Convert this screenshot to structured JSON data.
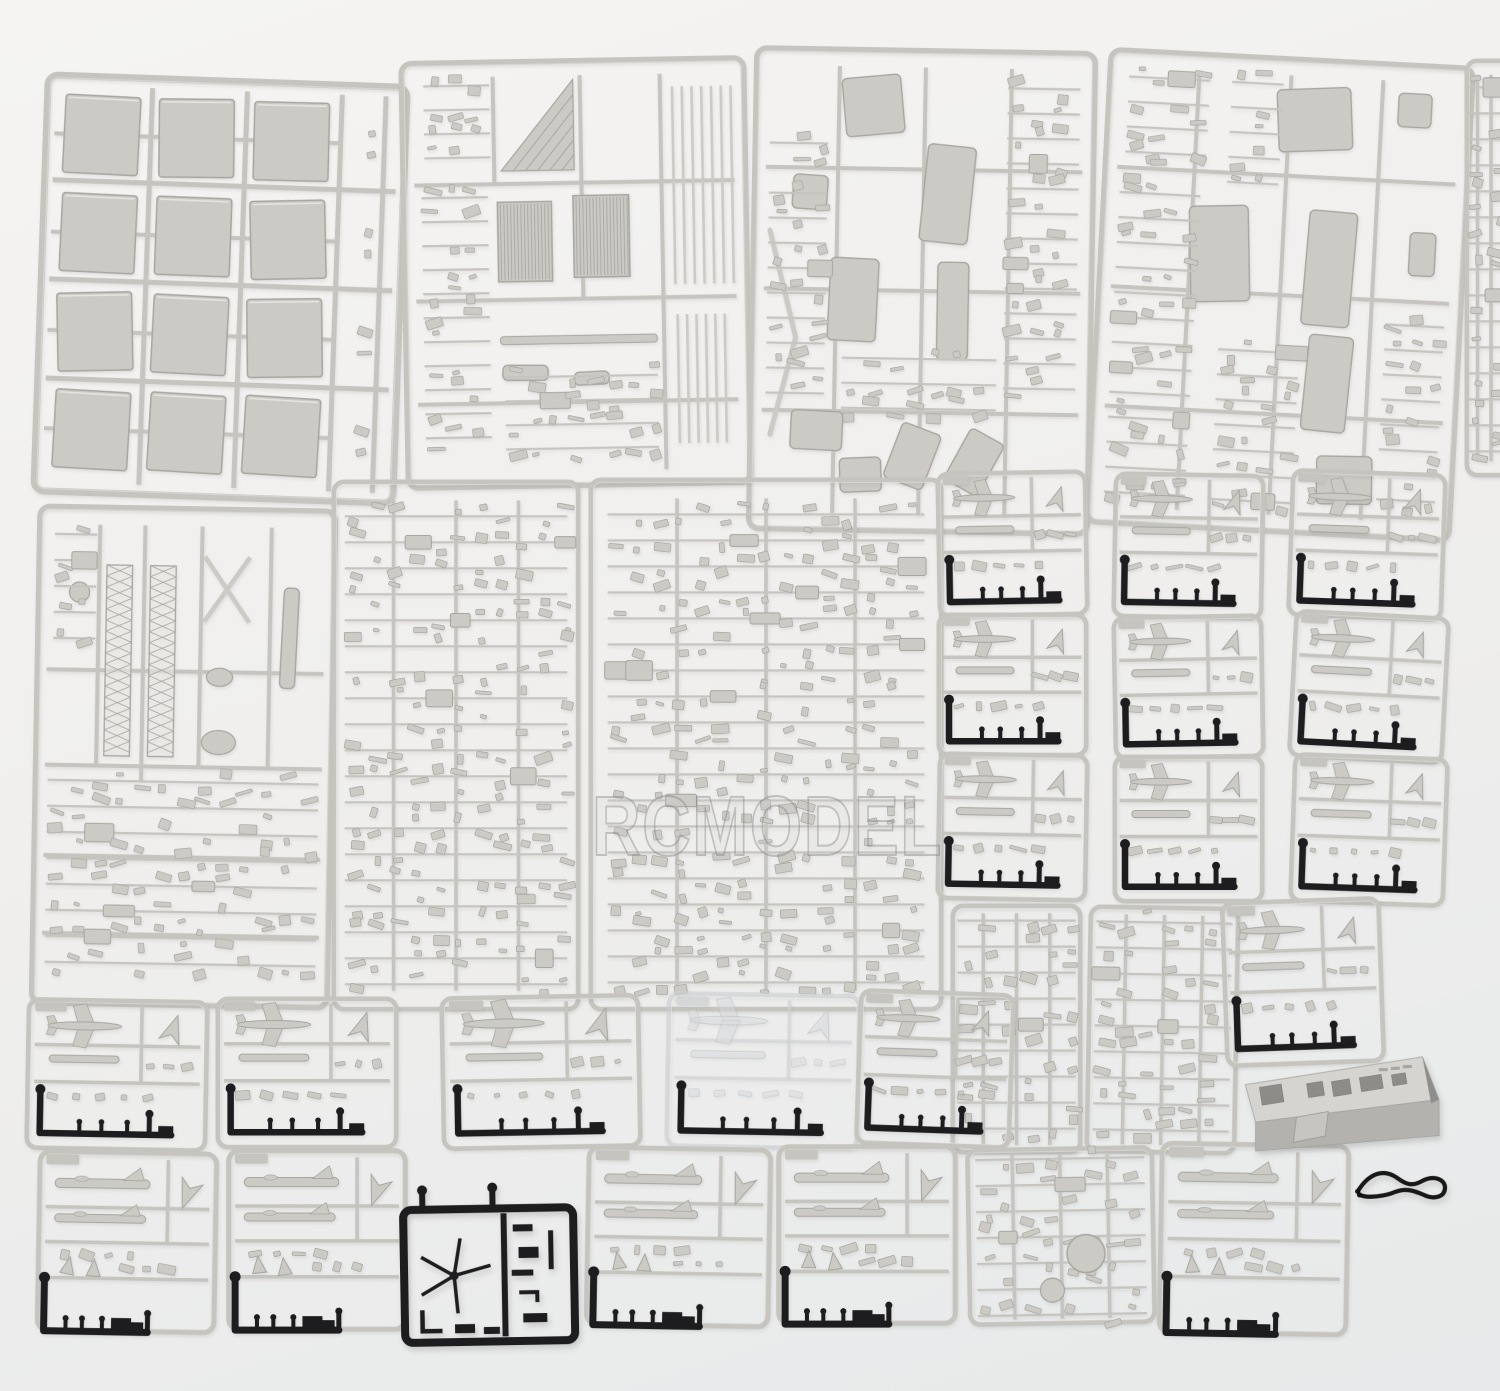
{
  "meta": {
    "width": 1500,
    "height": 1391,
    "description": "Overhead photo of an unassembled plastic scale-model kit: about 30 light-gray injection-molded sprues of ship and aircraft parts, several black sprues, a gray hull box part and a small black cord on a white backdrop"
  },
  "watermark": {
    "text": "RCMODEL"
  },
  "palette": {
    "background_top": "#f5f4f2",
    "background_mid": "#f0efed",
    "background_bottom": "#e7e9ea",
    "gray_frame": "#c5c4bf",
    "gray_part": "#cbcac5",
    "gray_edge": "#a7a6a1",
    "black_plastic": "#1d1d1f",
    "clear_frame": "rgba(207,209,212,0.65)",
    "clear_part": "rgba(220,222,225,0.50)",
    "clear_edge": "rgba(186,188,191,0.55)",
    "box_top": "#d5d4d0",
    "box_front": "#b3b2ae",
    "box_side": "#8f8e8a",
    "watermark_fill": "rgba(205,205,203,0.14)",
    "watermark_stroke": "rgba(125,125,123,0.40)"
  },
  "sprues": [
    {
      "name": "sprue-deck-panels",
      "kind": "deck",
      "x": 38,
      "y": 78,
      "w": 365,
      "h": 422,
      "rot": 2,
      "seed": 11
    },
    {
      "name": "sprue-grating-rods",
      "kind": "grating",
      "x": 402,
      "y": 58,
      "w": 348,
      "h": 430,
      "rot": -1,
      "seed": 22,
      "zones": [
        [
          0.06,
          0.32,
          0.25,
          0.93
        ],
        [
          0.07,
          0.06,
          0.26,
          0.26
        ],
        [
          0.29,
          0.74,
          0.73,
          0.94
        ]
      ]
    },
    {
      "name": "sprue-hull-fittings",
      "kind": "mixed",
      "x": 750,
      "y": 48,
      "w": 344,
      "h": 486,
      "rot": 1,
      "seed": 33,
      "chevron": true,
      "blobs": [
        [
          0.35,
          0.12,
          0.17,
          0.12,
          -6
        ],
        [
          0.17,
          0.3,
          0.1,
          0.07,
          3
        ],
        [
          0.57,
          0.3,
          0.14,
          0.2,
          5
        ],
        [
          0.3,
          0.52,
          0.14,
          0.17,
          2
        ],
        [
          0.59,
          0.54,
          0.09,
          0.2,
          0
        ],
        [
          0.2,
          0.79,
          0.15,
          0.08,
          2
        ],
        [
          0.33,
          0.88,
          0.12,
          0.07,
          -3
        ],
        [
          0.48,
          0.84,
          0.12,
          0.12,
          20
        ],
        [
          0.66,
          0.85,
          0.11,
          0.12,
          28
        ]
      ],
      "zones": [
        [
          0.05,
          0.2,
          0.22,
          0.72
        ],
        [
          0.74,
          0.08,
          0.95,
          0.72
        ],
        [
          0.27,
          0.64,
          0.72,
          0.76
        ]
      ]
    },
    {
      "name": "sprue-sponson-parts",
      "kind": "mixed",
      "x": 1096,
      "y": 56,
      "w": 368,
      "h": 478,
      "rot": 3,
      "seed": 44,
      "blobs": [
        [
          0.57,
          0.13,
          0.2,
          0.13,
          -5
        ],
        [
          0.84,
          0.1,
          0.09,
          0.07,
          0
        ],
        [
          0.33,
          0.42,
          0.16,
          0.2,
          -4
        ],
        [
          0.63,
          0.44,
          0.13,
          0.24,
          2
        ],
        [
          0.64,
          0.68,
          0.12,
          0.2,
          3
        ],
        [
          0.7,
          0.88,
          0.15,
          0.1,
          -2
        ],
        [
          0.88,
          0.4,
          0.07,
          0.09,
          0
        ]
      ],
      "zones": [
        [
          0.05,
          0.25,
          0.27,
          0.94
        ],
        [
          0.34,
          0.62,
          0.56,
          0.94
        ],
        [
          0.79,
          0.55,
          0.95,
          0.94
        ],
        [
          0.34,
          0.06,
          0.48,
          0.3
        ],
        [
          0.06,
          0.06,
          0.28,
          0.22
        ]
      ]
    },
    {
      "name": "sprue-right-edge-clipped",
      "kind": "dense",
      "x": 1464,
      "y": 58,
      "w": 54,
      "h": 420,
      "rot": 0,
      "seed": 55
    },
    {
      "name": "sprue-mast-details",
      "kind": "mast",
      "x": 33,
      "y": 506,
      "w": 301,
      "h": 502,
      "rot": 1,
      "seed": 66
    },
    {
      "name": "sprue-small-fittings-a",
      "kind": "dense",
      "x": 331,
      "y": 479,
      "w": 250,
      "h": 533,
      "rot": 0,
      "seed": 77
    },
    {
      "name": "sprue-small-fittings-b",
      "kind": "dense",
      "x": 588,
      "y": 477,
      "w": 356,
      "h": 535,
      "rot": 0,
      "seed": 78
    },
    {
      "name": "sprue-aircraft-1",
      "kind": "aircraft",
      "x": 936,
      "y": 470,
      "w": 153,
      "h": 148,
      "rot": -1,
      "seed": 101
    },
    {
      "name": "sprue-aircraft-2",
      "kind": "aircraft",
      "x": 1112,
      "y": 472,
      "w": 153,
      "h": 148,
      "rot": 1,
      "seed": 102
    },
    {
      "name": "sprue-aircraft-3",
      "kind": "aircraft",
      "x": 1288,
      "y": 470,
      "w": 158,
      "h": 150,
      "rot": 2,
      "seed": 103
    },
    {
      "name": "sprue-aircraft-4",
      "kind": "aircraft",
      "x": 936,
      "y": 612,
      "w": 153,
      "h": 146,
      "rot": 0,
      "seed": 104
    },
    {
      "name": "sprue-aircraft-5",
      "kind": "aircraft",
      "x": 1112,
      "y": 614,
      "w": 153,
      "h": 146,
      "rot": -1,
      "seed": 105
    },
    {
      "name": "sprue-aircraft-6",
      "kind": "aircraft",
      "x": 1290,
      "y": 612,
      "w": 158,
      "h": 150,
      "rot": 3,
      "seed": 106
    },
    {
      "name": "sprue-aircraft-7",
      "kind": "aircraft",
      "x": 936,
      "y": 752,
      "w": 153,
      "h": 150,
      "rot": 1,
      "seed": 107
    },
    {
      "name": "sprue-aircraft-8",
      "kind": "aircraft",
      "x": 1112,
      "y": 754,
      "w": 153,
      "h": 150,
      "rot": 0,
      "seed": 108
    },
    {
      "name": "sprue-aircraft-9",
      "kind": "aircraft",
      "x": 1290,
      "y": 754,
      "w": 158,
      "h": 152,
      "rot": 2,
      "seed": 109
    },
    {
      "name": "sprue-weapons-dense-1",
      "kind": "dense",
      "x": 950,
      "y": 903,
      "w": 133,
      "h": 252,
      "rot": 0,
      "seed": 87
    },
    {
      "name": "sprue-weapons-dense-2",
      "kind": "dense",
      "x": 1086,
      "y": 905,
      "w": 153,
      "h": 250,
      "rot": 1,
      "seed": 88
    },
    {
      "name": "sprue-aircraft-10",
      "kind": "aircraft",
      "x": 1222,
      "y": 898,
      "w": 162,
      "h": 168,
      "rot": -2,
      "seed": 89
    },
    {
      "name": "sprue-aircraft-11",
      "kind": "aircraft",
      "x": 25,
      "y": 998,
      "w": 184,
      "h": 154,
      "rot": 1,
      "seed": 201
    },
    {
      "name": "sprue-aircraft-12",
      "kind": "aircraft",
      "x": 215,
      "y": 996,
      "w": 184,
      "h": 154,
      "rot": 0,
      "seed": 202
    },
    {
      "name": "sprue-aircraft-13",
      "kind": "aircraft",
      "x": 440,
      "y": 994,
      "w": 202,
      "h": 156,
      "rot": -1,
      "seed": 203
    },
    {
      "name": "sprue-aircraft-14",
      "kind": "aircraft",
      "x": 665,
      "y": 992,
      "w": 196,
      "h": 158,
      "rot": 1,
      "seed": 204,
      "clear": true
    },
    {
      "name": "sprue-aircraft-15",
      "kind": "aircraft",
      "x": 856,
      "y": 990,
      "w": 158,
      "h": 158,
      "rot": 2,
      "seed": 205
    },
    {
      "name": "sprue-jet-aircraft-1",
      "kind": "jets",
      "x": 36,
      "y": 1150,
      "w": 182,
      "h": 184,
      "rot": 1,
      "seed": 25
    },
    {
      "name": "sprue-jet-aircraft-2",
      "kind": "jets",
      "x": 226,
      "y": 1148,
      "w": 182,
      "h": 184,
      "rot": 0,
      "seed": 26
    },
    {
      "name": "sprue-rotor-black",
      "kind": "rotor",
      "x": 400,
      "y": 1186,
      "w": 180,
      "h": 162,
      "rot": -1,
      "seed": 27
    },
    {
      "name": "sprue-jet-aircraft-3",
      "kind": "jets",
      "x": 585,
      "y": 1146,
      "w": 187,
      "h": 182,
      "rot": 1,
      "seed": 28
    },
    {
      "name": "sprue-jet-aircraft-4",
      "kind": "jets",
      "x": 776,
      "y": 1144,
      "w": 182,
      "h": 182,
      "rot": 0,
      "seed": 29
    },
    {
      "name": "sprue-misc-dense-disc",
      "kind": "dense",
      "x": 966,
      "y": 1146,
      "w": 190,
      "h": 180,
      "rot": -1,
      "seed": 30,
      "disc": true
    },
    {
      "name": "sprue-aircraft-16",
      "kind": "jets",
      "x": 1158,
      "y": 1142,
      "w": 192,
      "h": 194,
      "rot": 1,
      "seed": 31
    },
    {
      "name": "hull-box-part",
      "kind": "box3d",
      "x": 1240,
      "y": 1058,
      "w": 200,
      "h": 90,
      "rot": -2,
      "seed": 32
    },
    {
      "name": "black-cord",
      "kind": "cord",
      "x": 1352,
      "y": 1166,
      "w": 100,
      "h": 42,
      "rot": 3,
      "seed": 34
    }
  ]
}
